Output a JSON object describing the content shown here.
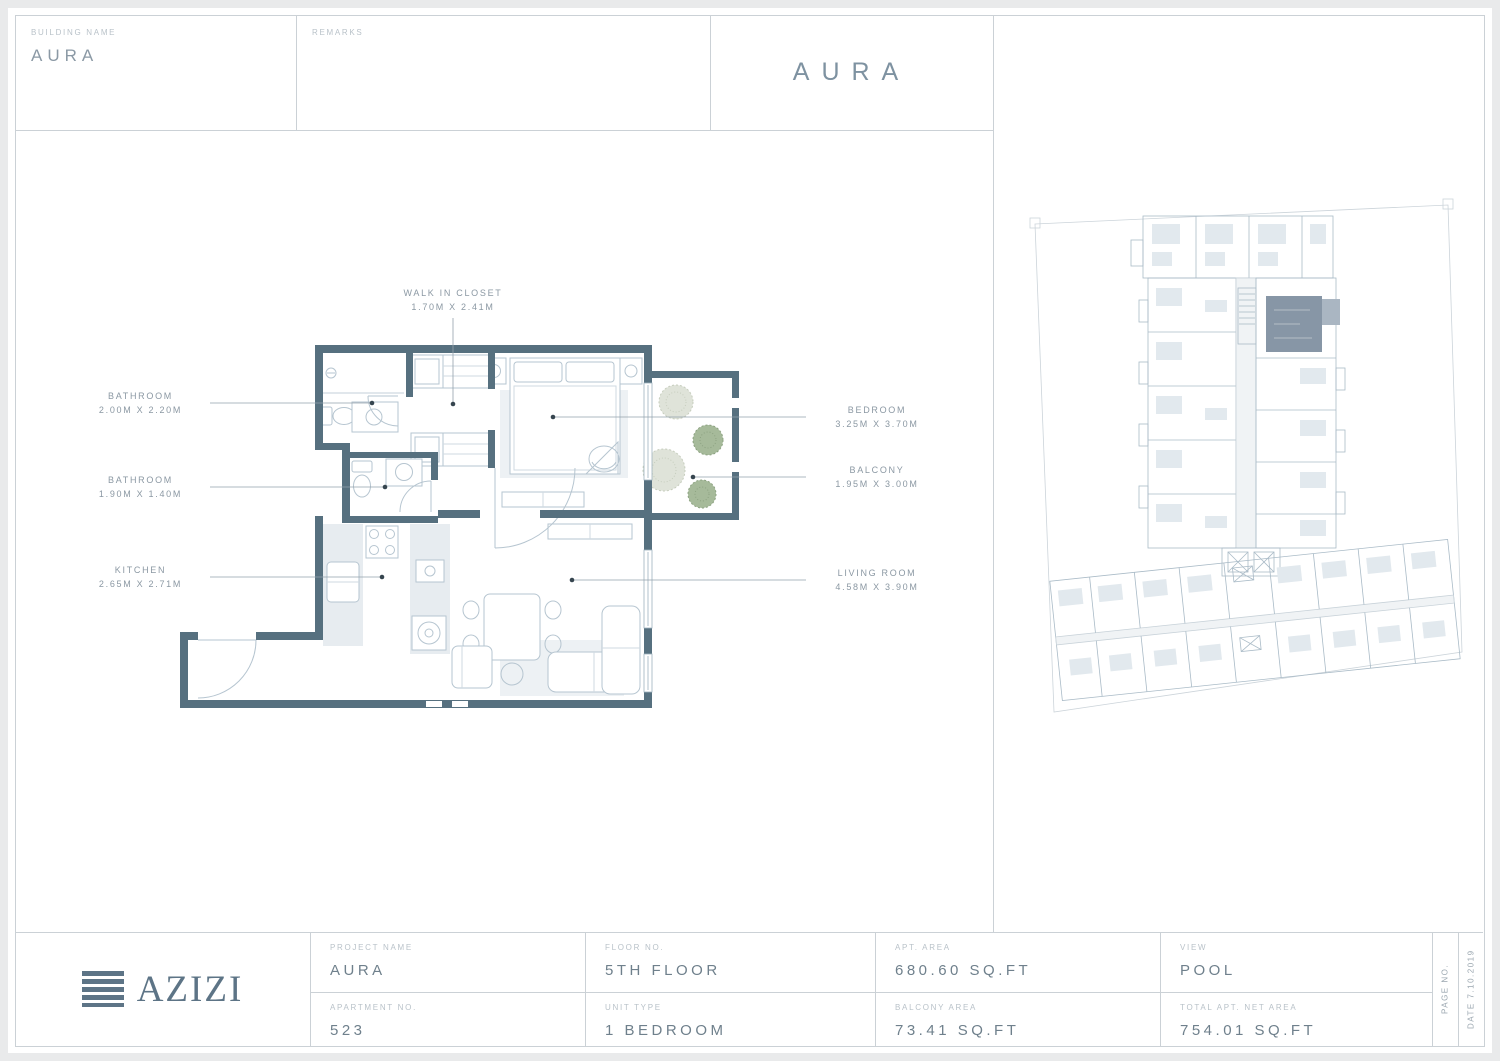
{
  "colors": {
    "page_bg": "#e9eaeb",
    "sheet": "#ffffff",
    "rule_line": "#cbd1d6",
    "wall": "#56707f",
    "furniture_line": "#b6c5d0",
    "light_fill": "#e7ecf0",
    "rug_fill": "#edf1f4",
    "leader": "#93a0ab",
    "label_text": "#b9c2c9",
    "value_text": "#6f808c",
    "accent_slate": "#7e92a1",
    "plant_green": "#a6ba9a",
    "plant_pale": "#dfe3d9",
    "keyplan_line": "#aabbc7",
    "unit_highlight": "#8796a6"
  },
  "header": {
    "building_name_label": "BUILDING NAME",
    "building_name": "AURA",
    "remarks_label": "REMARKS",
    "title": "AURA"
  },
  "plan_labels": [
    {
      "name": "WALK IN CLOSET",
      "dims": "1.70M X 2.41M"
    },
    {
      "name": "BATHROOM",
      "dims": "2.00M X 2.20M"
    },
    {
      "name": "BATHROOM",
      "dims": "1.90M X 1.40M"
    },
    {
      "name": "KITCHEN",
      "dims": "2.65M X 2.71M"
    },
    {
      "name": "BEDROOM",
      "dims": "3.25M X 3.70M"
    },
    {
      "name": "BALCONY",
      "dims": "1.95M X 3.00M"
    },
    {
      "name": "LIVING ROOM",
      "dims": "4.58M X 3.90M"
    }
  ],
  "footer": {
    "logo_text": "AZIZI",
    "cells": [
      {
        "label": "PROJECT NAME",
        "value": "AURA"
      },
      {
        "label": "FLOOR NO.",
        "value": "5TH FLOOR"
      },
      {
        "label": "APT. AREA",
        "value": "680.60 SQ.FT"
      },
      {
        "label": "VIEW",
        "value": "POOL"
      },
      {
        "label": "APARTMENT NO.",
        "value": "523"
      },
      {
        "label": "UNIT TYPE",
        "value": "1 BEDROOM"
      },
      {
        "label": "BALCONY AREA",
        "value": "73.41 SQ.FT"
      },
      {
        "label": "TOTAL APT. NET AREA",
        "value": "754.01 SQ.FT"
      }
    ],
    "page_no_label": "PAGE NO.",
    "date_label": "DATE 7.10.2019"
  }
}
